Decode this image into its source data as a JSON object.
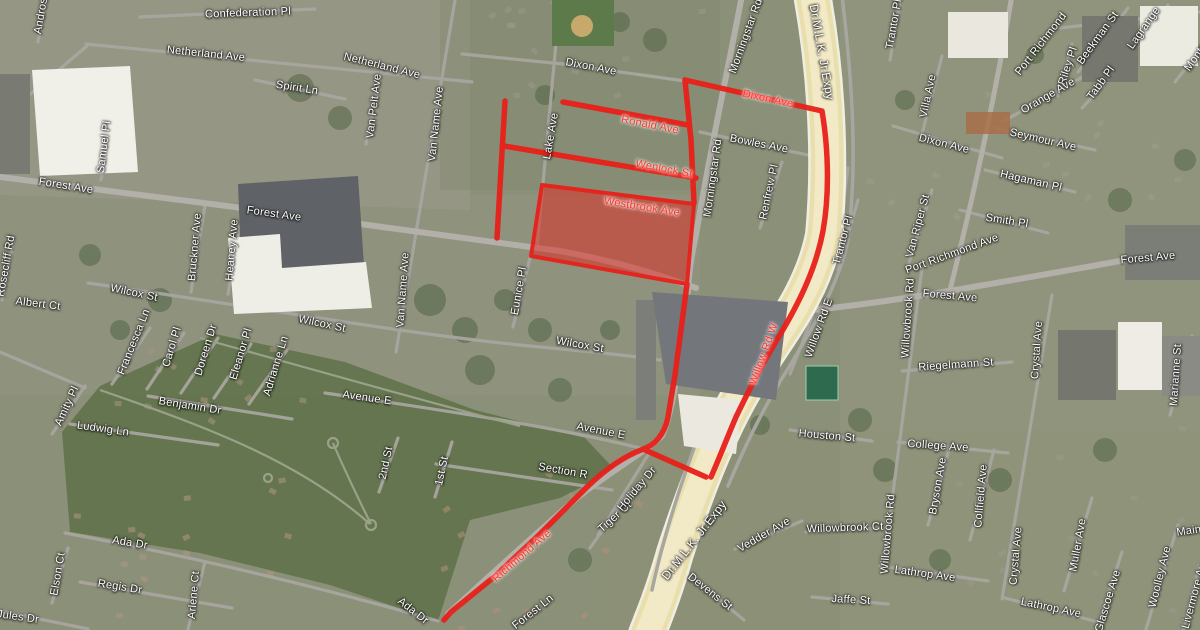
{
  "map": {
    "type": "satellite-map-with-route-overlay",
    "colors": {
      "route_red": "#e8201a",
      "highlight_area_fill": "rgba(232,30,22,0.5)",
      "highway_yellow": "#e9dfad",
      "road_gray": "#a8a6a0",
      "label_white": "#ffffff",
      "label_red": "#ff352a"
    },
    "highlighted_area_street": "Westbrook Ave"
  },
  "labels": [
    {
      "t": "Andros",
      "x": 41,
      "y": 16,
      "r": -80
    },
    {
      "t": "Confederation Pl",
      "x": 248,
      "y": 13,
      "r": -2
    },
    {
      "t": "Netherland Ave",
      "x": 206,
      "y": 54,
      "r": 6
    },
    {
      "t": "Netherland Ave",
      "x": 382,
      "y": 66,
      "r": 14
    },
    {
      "t": "Spirit Ln",
      "x": 297,
      "y": 88,
      "r": 9
    },
    {
      "t": "Samuel Pl",
      "x": 104,
      "y": 147,
      "r": -83
    },
    {
      "t": "Van Pelt Ave",
      "x": 374,
      "y": 106,
      "r": -83
    },
    {
      "t": "Van Name Ave",
      "x": 436,
      "y": 124,
      "r": -84
    },
    {
      "t": "Forest Ave",
      "x": 66,
      "y": 186,
      "r": 9
    },
    {
      "t": "Forest Ave",
      "x": 274,
      "y": 214,
      "r": 8
    },
    {
      "t": "Dixon Ave",
      "x": 591,
      "y": 67,
      "r": 11
    },
    {
      "t": "Lake Ave",
      "x": 551,
      "y": 136,
      "r": -80
    },
    {
      "t": "Morningstar Rd",
      "x": 746,
      "y": 36,
      "r": -70
    },
    {
      "t": "Dixon Ave",
      "x": 768,
      "y": 99,
      "r": 12,
      "c": "red"
    },
    {
      "t": "Ronald Ave",
      "x": 650,
      "y": 125,
      "r": 11,
      "c": "red"
    },
    {
      "t": "Bowles Ave",
      "x": 759,
      "y": 144,
      "r": 11
    },
    {
      "t": "Wenlock St",
      "x": 664,
      "y": 169,
      "r": 11,
      "c": "red"
    },
    {
      "t": "Morningstar Rd",
      "x": 713,
      "y": 178,
      "r": -82
    },
    {
      "t": "Renfrew Pl",
      "x": 769,
      "y": 192,
      "r": -78
    },
    {
      "t": "Westbrook Ave",
      "x": 642,
      "y": 207,
      "r": 9,
      "c": "red"
    },
    {
      "t": "Dr.M.L.K. Jr.Expy",
      "x": 822,
      "y": 52,
      "r": 80,
      "s": 12
    },
    {
      "t": "Trantor Pl",
      "x": 894,
      "y": 24,
      "r": -80
    },
    {
      "t": "Port Richmond",
      "x": 1041,
      "y": 44,
      "r": -52
    },
    {
      "t": "Beekman St",
      "x": 1098,
      "y": 38,
      "r": -54
    },
    {
      "t": "Riley Pl",
      "x": 1068,
      "y": 66,
      "r": -72
    },
    {
      "t": "Tabb Pl",
      "x": 1101,
      "y": 83,
      "r": -54
    },
    {
      "t": "Lagrange",
      "x": 1144,
      "y": 28,
      "r": -55
    },
    {
      "t": "Monte",
      "x": 1196,
      "y": 57,
      "r": -55
    },
    {
      "t": "Orange Ave",
      "x": 1048,
      "y": 96,
      "r": -30
    },
    {
      "t": "Dixon Ave",
      "x": 944,
      "y": 144,
      "r": 14
    },
    {
      "t": "Seymour Ave",
      "x": 1043,
      "y": 140,
      "r": 13
    },
    {
      "t": "Hagaman Pl",
      "x": 1031,
      "y": 181,
      "r": 13
    },
    {
      "t": "Villa Ave",
      "x": 928,
      "y": 96,
      "r": -78
    },
    {
      "t": "Smith Pl",
      "x": 1007,
      "y": 221,
      "r": 9
    },
    {
      "t": "Port Richmond Ave",
      "x": 952,
      "y": 254,
      "r": -20
    },
    {
      "t": "Van Riper St",
      "x": 918,
      "y": 226,
      "r": -75
    },
    {
      "t": "Forest Ave",
      "x": 950,
      "y": 296,
      "r": 5
    },
    {
      "t": "Forest Ave",
      "x": 1148,
      "y": 258,
      "r": -5
    },
    {
      "t": "Willowbrook Rd",
      "x": 908,
      "y": 318,
      "r": -86
    },
    {
      "t": "Trantor Pl",
      "x": 843,
      "y": 240,
      "r": -75
    },
    {
      "t": "Willow Rd E",
      "x": 819,
      "y": 328,
      "r": -70
    },
    {
      "t": "Willow Rd W",
      "x": 764,
      "y": 354,
      "r": -70,
      "c": "red"
    },
    {
      "t": "Riegelmann St",
      "x": 956,
      "y": 365,
      "r": -4
    },
    {
      "t": "Crystal Ave",
      "x": 1037,
      "y": 350,
      "r": -86
    },
    {
      "t": "Marianne St",
      "x": 1176,
      "y": 375,
      "r": -86
    },
    {
      "t": "Rosecliff Rd",
      "x": 6,
      "y": 266,
      "r": -80
    },
    {
      "t": "Albert Ct",
      "x": 38,
      "y": 304,
      "r": 7
    },
    {
      "t": "Wilcox St",
      "x": 134,
      "y": 293,
      "r": 12
    },
    {
      "t": "Wilcox St",
      "x": 322,
      "y": 324,
      "r": 12
    },
    {
      "t": "Wilcox St",
      "x": 580,
      "y": 345,
      "r": 10
    },
    {
      "t": "Bruckner Ave",
      "x": 195,
      "y": 247,
      "r": -85
    },
    {
      "t": "Heaney Ave",
      "x": 232,
      "y": 250,
      "r": -85
    },
    {
      "t": "Van Name Ave",
      "x": 403,
      "y": 290,
      "r": -86
    },
    {
      "t": "Eunice Pl",
      "x": 519,
      "y": 291,
      "r": -80
    },
    {
      "t": "Francesca Ln",
      "x": 134,
      "y": 342,
      "r": -68
    },
    {
      "t": "Carol Pl",
      "x": 172,
      "y": 347,
      "r": -73
    },
    {
      "t": "Doreen Dr",
      "x": 206,
      "y": 350,
      "r": -73
    },
    {
      "t": "Eleanor Pl",
      "x": 241,
      "y": 354,
      "r": -73
    },
    {
      "t": "Adrianne Ln",
      "x": 276,
      "y": 366,
      "r": -73
    },
    {
      "t": "Benjamin Dr",
      "x": 190,
      "y": 406,
      "r": 9
    },
    {
      "t": "Avenue E",
      "x": 367,
      "y": 398,
      "r": 8
    },
    {
      "t": "Avenue E",
      "x": 601,
      "y": 431,
      "r": 11
    },
    {
      "t": "Amity Pl",
      "x": 67,
      "y": 406,
      "r": -65
    },
    {
      "t": "Ludwig Ln",
      "x": 103,
      "y": 429,
      "r": 8
    },
    {
      "t": "2nd St",
      "x": 386,
      "y": 463,
      "r": -78
    },
    {
      "t": "1st St",
      "x": 442,
      "y": 471,
      "r": -78
    },
    {
      "t": "Section R",
      "x": 563,
      "y": 471,
      "r": 10
    },
    {
      "t": "Tiger Ct",
      "x": 615,
      "y": 517,
      "r": -42
    },
    {
      "t": "Holiday Dr",
      "x": 637,
      "y": 489,
      "r": -50
    },
    {
      "t": "Richmond Ave",
      "x": 522,
      "y": 556,
      "r": -41,
      "c": "red"
    },
    {
      "t": "Dr.M.L.K. Jr.Expy",
      "x": 694,
      "y": 540,
      "r": -52,
      "s": 12
    },
    {
      "t": "Vedder Ave",
      "x": 764,
      "y": 535,
      "r": -30
    },
    {
      "t": "Houston St",
      "x": 827,
      "y": 436,
      "r": 5
    },
    {
      "t": "Devens St",
      "x": 710,
      "y": 592,
      "r": 38
    },
    {
      "t": "Willowbrook Ct",
      "x": 845,
      "y": 528,
      "r": -2
    },
    {
      "t": "Willowbrook Rd",
      "x": 888,
      "y": 534,
      "r": -85
    },
    {
      "t": "College Ave",
      "x": 938,
      "y": 446,
      "r": 4
    },
    {
      "t": "Bryson Ave",
      "x": 938,
      "y": 486,
      "r": -80
    },
    {
      "t": "Collfield Ave",
      "x": 981,
      "y": 496,
      "r": -85
    },
    {
      "t": "Crystal Ave",
      "x": 1016,
      "y": 556,
      "r": -85
    },
    {
      "t": "Muller Ave",
      "x": 1078,
      "y": 545,
      "r": -80
    },
    {
      "t": "Woolley Ave",
      "x": 1160,
      "y": 577,
      "r": -76
    },
    {
      "t": "Glascoe Ave",
      "x": 1108,
      "y": 601,
      "r": -73
    },
    {
      "t": "Livermore Ave",
      "x": 1195,
      "y": 593,
      "r": -75
    },
    {
      "t": "Maine Ave",
      "x": 1203,
      "y": 529,
      "r": -8
    },
    {
      "t": "Lathrop Ave",
      "x": 925,
      "y": 574,
      "r": 8
    },
    {
      "t": "Lathrop Ave",
      "x": 1051,
      "y": 608,
      "r": 12
    },
    {
      "t": "Jaffe St",
      "x": 851,
      "y": 600,
      "r": 3
    },
    {
      "t": "Elson Ct",
      "x": 58,
      "y": 574,
      "r": -80
    },
    {
      "t": "Regis Dr",
      "x": 120,
      "y": 587,
      "r": 9
    },
    {
      "t": "Arlene Ct",
      "x": 194,
      "y": 595,
      "r": -85
    },
    {
      "t": "Jules Dr",
      "x": 18,
      "y": 617,
      "r": 8
    },
    {
      "t": "Ada Dr",
      "x": 130,
      "y": 543,
      "r": 9
    },
    {
      "t": "Ada Dr",
      "x": 413,
      "y": 611,
      "r": 38
    },
    {
      "t": "Forest Ln",
      "x": 533,
      "y": 612,
      "r": -38
    }
  ]
}
